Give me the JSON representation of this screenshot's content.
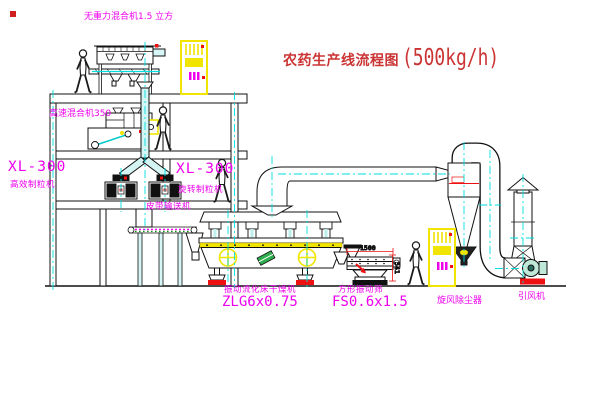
{
  "title": {
    "zh": "农药生产线流程图",
    "capacity": "(500kg/h)"
  },
  "equipment": {
    "gravity_mixer": {
      "label": "无重力混合机1.5 立方"
    },
    "speed_mixer": {
      "label": "高速混合机350"
    },
    "granulator_left": {
      "model": "XL-300",
      "name": "高效制粒机"
    },
    "granulator_mid": {
      "model": "XL-300",
      "name": "旋转制粒机"
    },
    "belt_conveyor": {
      "label": "皮带输送机"
    },
    "dryer": {
      "name": "振动流化床干燥机",
      "model": "ZLG6x0.75"
    },
    "sieve": {
      "name": "方形振动筛",
      "model": "FS0.6x1.5"
    },
    "cyclone": {
      "name": "旋风除尘器"
    },
    "fan": {
      "name": "引风机"
    }
  },
  "dimensions": {
    "sieve_length": "1500",
    "sieve_height": "541"
  },
  "colors": {
    "label_magenta": "#ee00ee",
    "title_red": "#cb3434",
    "centerline_cyan": "#00dede",
    "accent_red": "#ee1111",
    "cabinet_yellow": "#f0e400",
    "machine_green": "#2fae4e"
  }
}
